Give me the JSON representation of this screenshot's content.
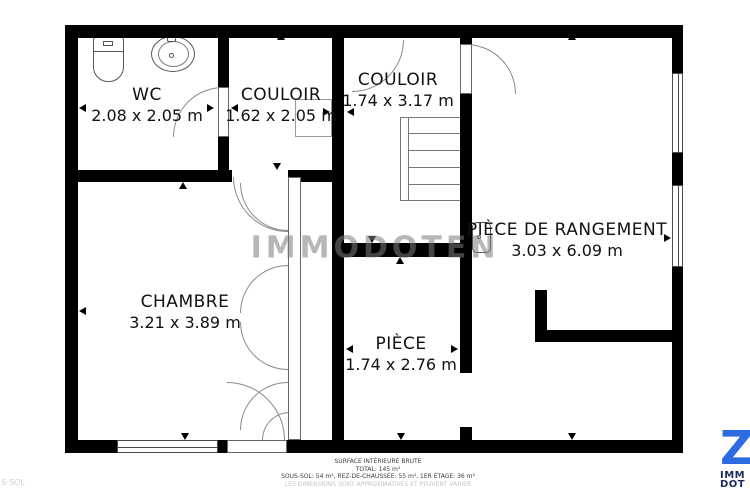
{
  "rooms": [
    {
      "id": "wc",
      "name": "WC",
      "dimensions": "2.08 x 2.05 m"
    },
    {
      "id": "couloir1",
      "name": "COULOIR",
      "dimensions": "1.62 x 2.05 m"
    },
    {
      "id": "couloir2",
      "name": "COULOIR",
      "dimensions": "1.74 x 3.17 m"
    },
    {
      "id": "rangement",
      "name": "PIÈCE DE RANGEMENT",
      "dimensions": "3.03 x 6.09 m"
    },
    {
      "id": "chambre",
      "name": "CHAMBRE",
      "dimensions": "3.21 x 3.89 m"
    },
    {
      "id": "piece",
      "name": "PIÈCE",
      "dimensions": "1.74 x 2.76 m"
    }
  ],
  "watermark": "IMMODOTEN",
  "footer": {
    "line1": "SURFACE INTÉRIEURE BRUTE",
    "line2": "TOTAL: 145 m²",
    "line3": "SOUS-SOL: 54 m², REZ-DE-CHAUSSÉE: 55 m², 1ER ÉTAGE: 36 m²",
    "line4": "LES DIMENSIONS SONT APPROXIMATIVES ET PEUVENT VARIER"
  },
  "edge_floor_label": "S-SOL",
  "logo": {
    "glyph": "Z",
    "line1": "IMM",
    "line2": "DOT",
    "glyph_color": "#2e6be2",
    "text_color": "#1b2a5a"
  },
  "colors": {
    "walls": "#000000",
    "fixtures_outline": "#555555",
    "watermark_gray": "#7d7d7d",
    "footer_muted": "#c3c3c3"
  }
}
